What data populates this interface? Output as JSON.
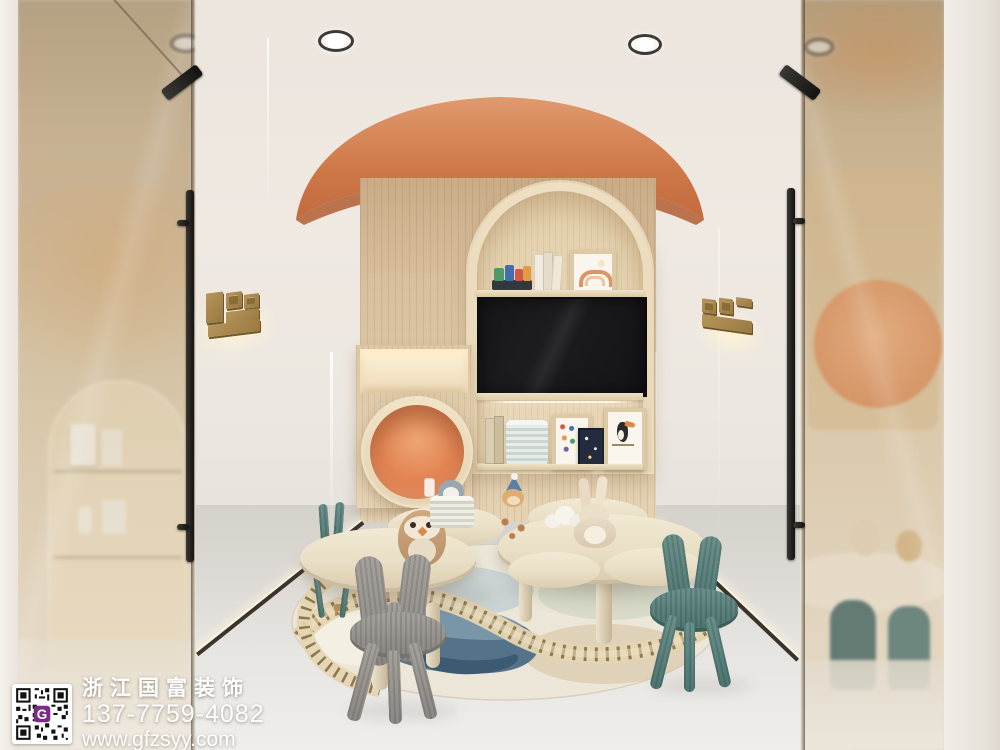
{
  "watermark": {
    "company": "浙江国富装饰",
    "phone": "137-7759-4082",
    "website": "www.gfzsyy.com",
    "qr_logo_letter": "G",
    "qr_logo_color": "#7a2b86"
  },
  "palette": {
    "wall": "#efe8e1",
    "accent_orange": "#cf7a4b",
    "canopy_top": "#dd9468",
    "canopy_bottom": "#c06a3e",
    "wood_light": "#dcc5a4",
    "niche_wood": "#e9d8bc",
    "pod_orange": "#e08b5c",
    "table_wood": "#e9dfca",
    "chair_gray": "#93908c",
    "chair_teal": "#5a807d",
    "rug_base": "#ece6d8",
    "rug_lake_dark": "#3c5a72",
    "rug_lake_light": "#7b97aa",
    "track_tie": "#8d7752",
    "tv_black": "#17171a",
    "sign_gold": "#a8894f",
    "glass_tint": "#c4a87e",
    "floor": "#e3e0db",
    "led_warm": "#fff4d6"
  }
}
